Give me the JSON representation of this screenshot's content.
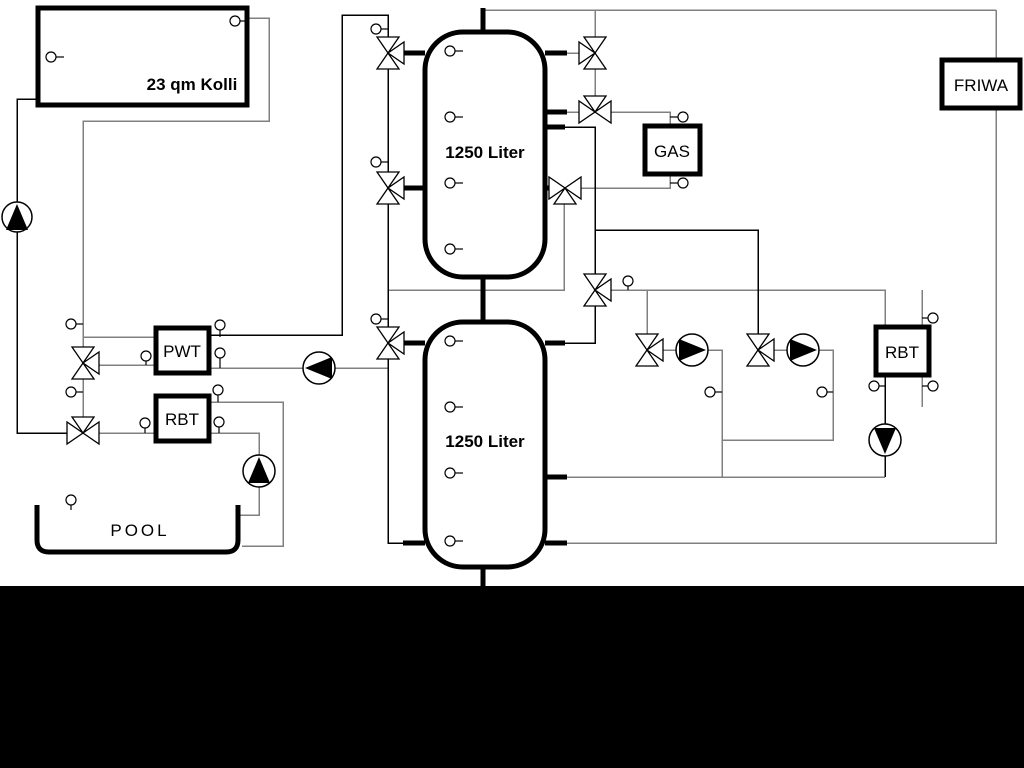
{
  "diagram": {
    "title": "heating-system-schematic",
    "labels": {
      "collector": "23 qm Kolli",
      "tank_top": "1250 Liter",
      "tank_bottom": "1250 Liter",
      "pwt": "PWT",
      "rbt_left": "RBT",
      "rbt_right": "RBT",
      "gas": "GAS",
      "friwa": "FRIWA",
      "pool": "POOL"
    },
    "colors": {
      "pipe_gray": "#808080",
      "pipe_black": "#000000",
      "background": "#ffffff",
      "bottom_band": "#000000"
    }
  }
}
